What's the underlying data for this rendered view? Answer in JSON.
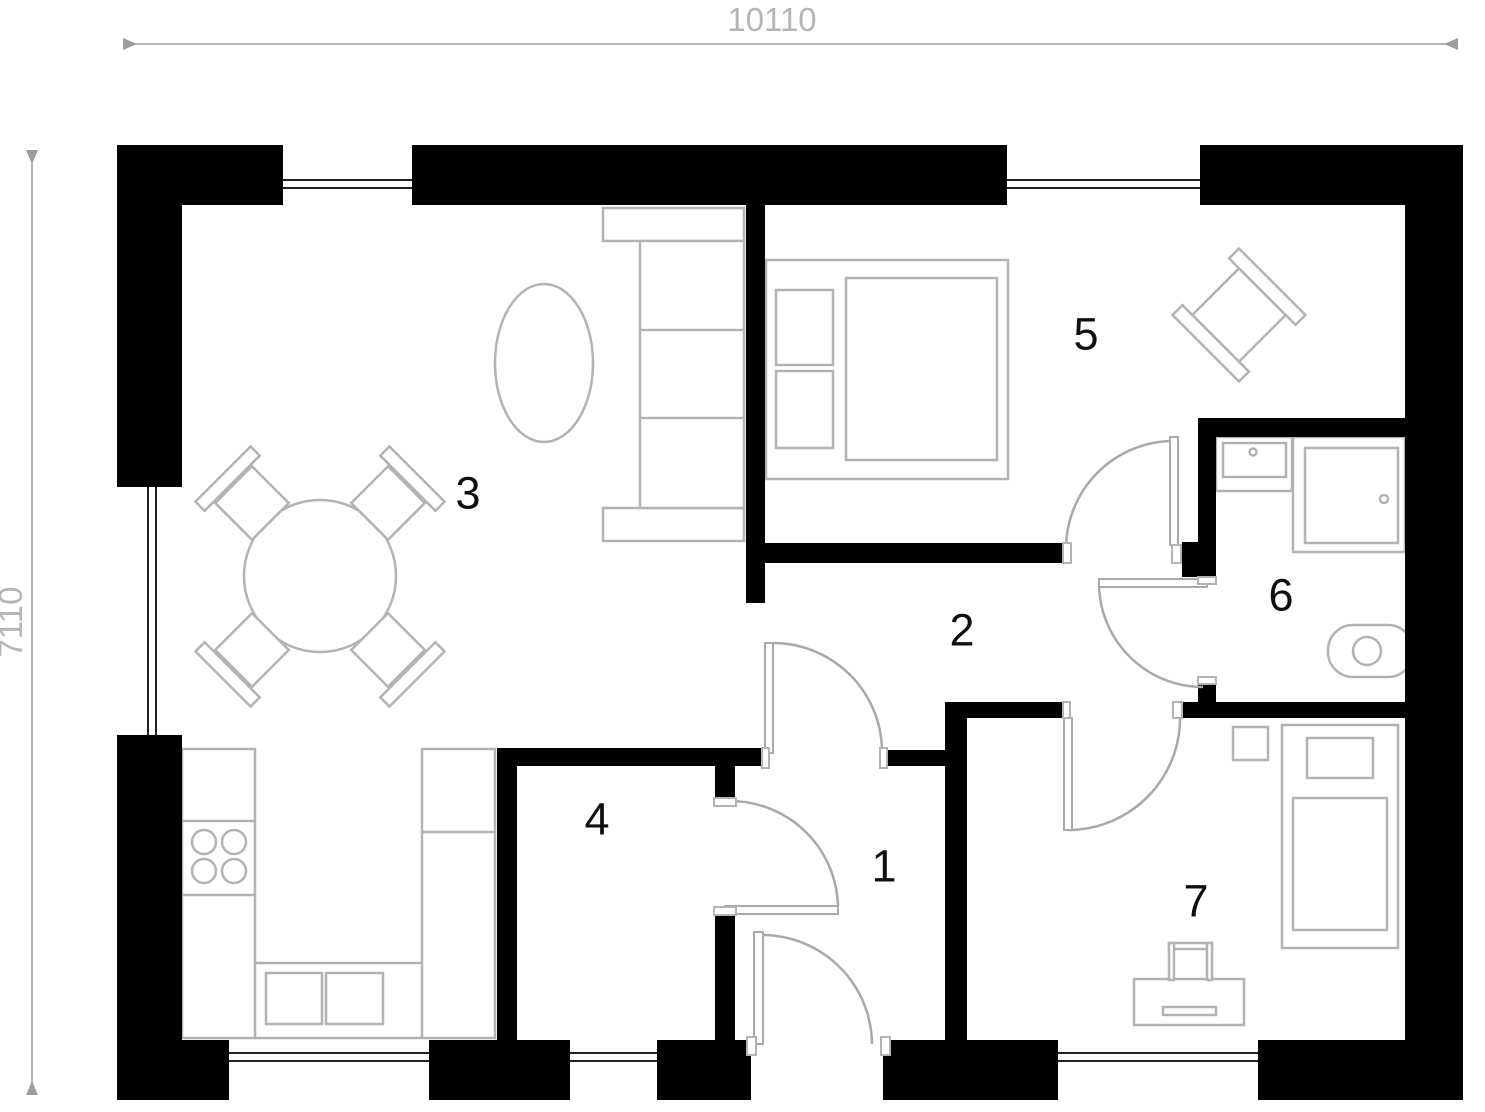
{
  "plan": {
    "width": 1485,
    "height": 1112,
    "colors": {
      "wall": "#000000",
      "furn": "#b3b3b3",
      "door": "#a9a9a9",
      "win": "#222222",
      "dim": "#9c9c9c",
      "dim_text": "#b5b5b5",
      "label": "#0f0f0f",
      "fill": "#ffffff"
    },
    "walls": [
      [
        117,
        145,
        166,
        60
      ],
      [
        412,
        145,
        595,
        60
      ],
      [
        1200,
        145,
        263,
        60
      ],
      [
        117,
        145,
        65,
        342
      ],
      [
        117,
        735,
        65,
        365
      ],
      [
        117,
        1040,
        112,
        60
      ],
      [
        429,
        1040,
        141,
        60
      ],
      [
        657,
        1040,
        94,
        60
      ],
      [
        883,
        1040,
        175,
        60
      ],
      [
        1258,
        1040,
        205,
        60
      ],
      [
        1405,
        145,
        58,
        955
      ],
      [
        746,
        205,
        19,
        398
      ],
      [
        746,
        543,
        317,
        20
      ],
      [
        1182,
        542,
        34,
        35
      ],
      [
        1198,
        418,
        207,
        19
      ],
      [
        1198,
        418,
        18,
        159
      ],
      [
        1198,
        683,
        18,
        33
      ],
      [
        945,
        702,
        118,
        16
      ],
      [
        1182,
        702,
        223,
        16
      ],
      [
        945,
        702,
        22,
        338
      ],
      [
        880,
        750,
        66,
        16
      ],
      [
        497,
        748,
        272,
        18
      ],
      [
        497,
        748,
        20,
        292
      ],
      [
        715,
        748,
        20,
        52
      ],
      [
        715,
        913,
        20,
        127
      ]
    ],
    "windows": [
      {
        "name": "window-living-top",
        "lines": [
          [
            283,
            180,
            412,
            180
          ],
          [
            283,
            188,
            412,
            188
          ]
        ]
      },
      {
        "name": "window-bedroom5-top",
        "lines": [
          [
            1007,
            180,
            1200,
            180
          ],
          [
            1007,
            188,
            1200,
            188
          ]
        ]
      },
      {
        "name": "window-living-left",
        "lines": [
          [
            148,
            487,
            148,
            735
          ],
          [
            156,
            487,
            156,
            735
          ]
        ]
      },
      {
        "name": "window-kitchen-bottom",
        "lines": [
          [
            229,
            1053,
            429,
            1053
          ],
          [
            229,
            1061,
            429,
            1061
          ]
        ]
      },
      {
        "name": "window-room4-bottom",
        "lines": [
          [
            570,
            1053,
            657,
            1053
          ],
          [
            570,
            1061,
            657,
            1061
          ]
        ]
      },
      {
        "name": "window-room7-bottom",
        "lines": [
          [
            1058,
            1053,
            1258,
            1053
          ],
          [
            1058,
            1061,
            1258,
            1061
          ]
        ]
      }
    ],
    "doors": [
      {
        "name": "door-hall-to-room1",
        "leaf": [
          765,
          643,
          8,
          110
        ],
        "arc": "M 773 643 A 109 109 0 0 1 882 752",
        "jambs": [
          [
            762,
            748,
            7,
            20
          ],
          [
            880,
            748,
            7,
            20
          ]
        ]
      },
      {
        "name": "door-room4",
        "leaf": [
          725,
          906,
          113,
          8
        ],
        "arc": "M 838 906 A 108 108 0 0 0 729 801",
        "jambs": [
          [
            714,
            798,
            22,
            8
          ],
          [
            714,
            907,
            22,
            8
          ]
        ]
      },
      {
        "name": "door-entrance",
        "leaf": [
          754,
          932,
          9,
          112
        ],
        "arc": "M 763 935 A 110 110 0 0 1 872 1044",
        "jambs": [
          [
            747,
            1037,
            9,
            18
          ],
          [
            881,
            1037,
            9,
            18
          ]
        ]
      },
      {
        "name": "door-bedroom5",
        "leaf": [
          1170,
          437,
          8,
          108
        ],
        "arc": "M 1170 441 A 108 108 0 0 0 1066 549",
        "jambs": [
          [
            1063,
            543,
            8,
            20
          ],
          [
            1172,
            545,
            9,
            18
          ]
        ]
      },
      {
        "name": "door-bathroom6",
        "leaf": [
          1099,
          579,
          108,
          8
        ],
        "arc": "M 1099 583 A 104 104 0 0 0 1203 687",
        "jambs": [
          [
            1198,
            577,
            18,
            7
          ],
          [
            1198,
            677,
            18,
            7
          ]
        ]
      },
      {
        "name": "door-room7",
        "leaf": [
          1064,
          718,
          8,
          112
        ],
        "arc": "M 1068 830 A 112 112 0 0 0 1180 718",
        "jambs": [
          [
            1063,
            702,
            7,
            16
          ],
          [
            1173,
            702,
            9,
            16
          ]
        ]
      }
    ],
    "furniture": [
      {
        "name": "sofa",
        "shapes": [
          {
            "t": "rect",
            "d": [
              603,
              208,
              141,
              33
            ]
          },
          {
            "t": "rect",
            "d": [
              603,
              508,
              141,
              33
            ]
          },
          {
            "t": "rect",
            "d": [
              640,
              241,
              104,
              267
            ]
          },
          {
            "t": "line",
            "d": [
              640,
              330,
              744,
              330
            ]
          },
          {
            "t": "line",
            "d": [
              640,
              418,
              744,
              418
            ]
          }
        ]
      },
      {
        "name": "rug-oval",
        "shapes": [
          {
            "t": "ellipse",
            "d": [
              544,
              363,
              49,
              79
            ]
          }
        ]
      },
      {
        "name": "dining-table",
        "shapes": [
          {
            "t": "circle",
            "d": [
              320,
              576,
              76
            ]
          }
        ]
      },
      {
        "name": "dining-chair-nw",
        "transform": "translate(252,503) rotate(45)",
        "shapes": [
          {
            "t": "rect",
            "d": [
              -26,
              -26,
              52,
              52
            ]
          },
          {
            "t": "rect",
            "d": [
              -41,
              -39,
              13,
              78
            ]
          }
        ]
      },
      {
        "name": "dining-chair-ne",
        "transform": "translate(388,503) rotate(45)",
        "shapes": [
          {
            "t": "rect",
            "d": [
              -26,
              -26,
              52,
              52
            ]
          },
          {
            "t": "rect",
            "d": [
              -39,
              -41,
              78,
              13
            ]
          }
        ]
      },
      {
        "name": "dining-chair-sw",
        "transform": "translate(252,650) rotate(45)",
        "shapes": [
          {
            "t": "rect",
            "d": [
              -26,
              -26,
              52,
              52
            ]
          },
          {
            "t": "rect",
            "d": [
              -39,
              28,
              78,
              13
            ]
          }
        ]
      },
      {
        "name": "dining-chair-se",
        "transform": "translate(388,650) rotate(45)",
        "shapes": [
          {
            "t": "rect",
            "d": [
              -26,
              -26,
              52,
              52
            ]
          },
          {
            "t": "rect",
            "d": [
              28,
              -39,
              13,
              78
            ]
          }
        ]
      },
      {
        "name": "double-bed",
        "shapes": [
          {
            "t": "rect",
            "d": [
              766,
              260,
              242,
              219
            ]
          },
          {
            "t": "rect",
            "d": [
              846,
              278,
              151,
              182
            ]
          },
          {
            "t": "rect",
            "d": [
              776,
              290,
              57,
              75
            ]
          },
          {
            "t": "rect",
            "d": [
              776,
              371,
              57,
              77
            ]
          }
        ]
      },
      {
        "name": "armchair-bedroom5",
        "transform": "translate(1239,315) rotate(45)",
        "shapes": [
          {
            "t": "rect",
            "d": [
              -33,
              -33,
              66,
              66
            ]
          },
          {
            "t": "rect",
            "d": [
              -47,
              -47,
              94,
              14
            ]
          },
          {
            "t": "rect",
            "d": [
              -47,
              33,
              94,
              14
            ]
          }
        ]
      },
      {
        "name": "sink",
        "shapes": [
          {
            "t": "rect",
            "d": [
              1216,
              437,
              76,
              54
            ]
          },
          {
            "t": "rect",
            "d": [
              1223,
              443,
              63,
              34
            ]
          },
          {
            "t": "circle",
            "d": [
              1253,
              452,
              3.5
            ]
          }
        ]
      },
      {
        "name": "shower",
        "shapes": [
          {
            "t": "rect",
            "d": [
              1293,
              437,
              112,
              115
            ]
          },
          {
            "t": "rect",
            "d": [
              1305,
              448,
              93,
              95
            ]
          },
          {
            "t": "circle",
            "d": [
              1384,
              499,
              4
            ]
          }
        ]
      },
      {
        "name": "toilet",
        "shapes": [
          {
            "t": "rect",
            "d": [
              1328,
              625,
              85,
              52
            ],
            "rx": 25
          },
          {
            "t": "circle",
            "d": [
              1367,
              651,
              14
            ]
          }
        ]
      },
      {
        "name": "nightstand-room7",
        "shapes": [
          {
            "t": "rect",
            "d": [
              1233,
              727,
              35,
              33
            ]
          }
        ]
      },
      {
        "name": "single-bed",
        "shapes": [
          {
            "t": "rect",
            "d": [
              1282,
              725,
              116,
              223
            ]
          },
          {
            "t": "rect",
            "d": [
              1307,
              738,
              66,
              40
            ]
          },
          {
            "t": "rect",
            "d": [
              1293,
              798,
              94,
              132
            ]
          }
        ]
      },
      {
        "name": "desk",
        "shapes": [
          {
            "t": "rect",
            "d": [
              1134,
              979,
              110,
              46
            ]
          },
          {
            "t": "rect",
            "d": [
              1163,
              1007,
              53,
              8
            ]
          }
        ]
      },
      {
        "name": "desk-chair",
        "shapes": [
          {
            "t": "rect",
            "d": [
              1169,
              943,
              43,
              6
            ]
          },
          {
            "t": "rect",
            "d": [
              1169,
              943,
              5,
              37
            ]
          },
          {
            "t": "rect",
            "d": [
              1207,
              943,
              5,
              37
            ]
          }
        ]
      },
      {
        "name": "kitchen-counter-left",
        "shapes": [
          {
            "t": "rect",
            "d": [
              182,
              749,
              73,
              289
            ]
          },
          {
            "t": "line",
            "d": [
              182,
              821,
              255,
              821
            ]
          },
          {
            "t": "line",
            "d": [
              182,
              895,
              255,
              895
            ]
          },
          {
            "t": "circle",
            "d": [
              204,
              842,
              12
            ]
          },
          {
            "t": "circle",
            "d": [
              234,
              842,
              12
            ]
          },
          {
            "t": "circle",
            "d": [
              204,
              871,
              12
            ]
          },
          {
            "t": "circle",
            "d": [
              234,
              871,
              12
            ]
          }
        ]
      },
      {
        "name": "kitchen-counter-right",
        "shapes": [
          {
            "t": "rect",
            "d": [
              422,
              749,
              73,
              289
            ]
          },
          {
            "t": "line",
            "d": [
              422,
              832,
              495,
              832
            ]
          }
        ]
      },
      {
        "name": "kitchen-counter-bottom",
        "shapes": [
          {
            "t": "line",
            "d": [
              255,
              963,
              422,
              963
            ]
          },
          {
            "t": "line",
            "d": [
              255,
              1038,
              422,
              1038
            ]
          },
          {
            "t": "rect",
            "d": [
              266,
              973,
              56,
              51
            ]
          },
          {
            "t": "rect",
            "d": [
              326,
              973,
              57,
              51
            ]
          }
        ]
      }
    ],
    "rooms": [
      {
        "label": "1",
        "x": 884,
        "y": 866
      },
      {
        "label": "2",
        "x": 962,
        "y": 630
      },
      {
        "label": "3",
        "x": 468,
        "y": 493
      },
      {
        "label": "4",
        "x": 597,
        "y": 819
      },
      {
        "label": "5",
        "x": 1086,
        "y": 334
      },
      {
        "label": "6",
        "x": 1281,
        "y": 595
      },
      {
        "label": "7",
        "x": 1196,
        "y": 901
      }
    ],
    "dimensions": {
      "top": {
        "label": "10110",
        "line": [
          123,
          44,
          1458,
          44
        ],
        "arrows": [
          [
            [
              123,
              38
            ],
            [
              123,
              50
            ],
            [
              137,
              44
            ]
          ],
          [
            [
              1458,
              38
            ],
            [
              1458,
              50
            ],
            [
              1444,
              44
            ]
          ]
        ],
        "text_pos": [
          772,
          31
        ],
        "rotate": 0
      },
      "left": {
        "label": "7110",
        "line": [
          32,
          150,
          32,
          1095
        ],
        "arrows": [
          [
            [
              26,
              150
            ],
            [
              38,
              150
            ],
            [
              32,
              164
            ]
          ],
          [
            [
              26,
              1095
            ],
            [
              38,
              1095
            ],
            [
              32,
              1081
            ]
          ]
        ],
        "text_pos": [
          22,
          622
        ],
        "rotate": -90
      }
    }
  }
}
